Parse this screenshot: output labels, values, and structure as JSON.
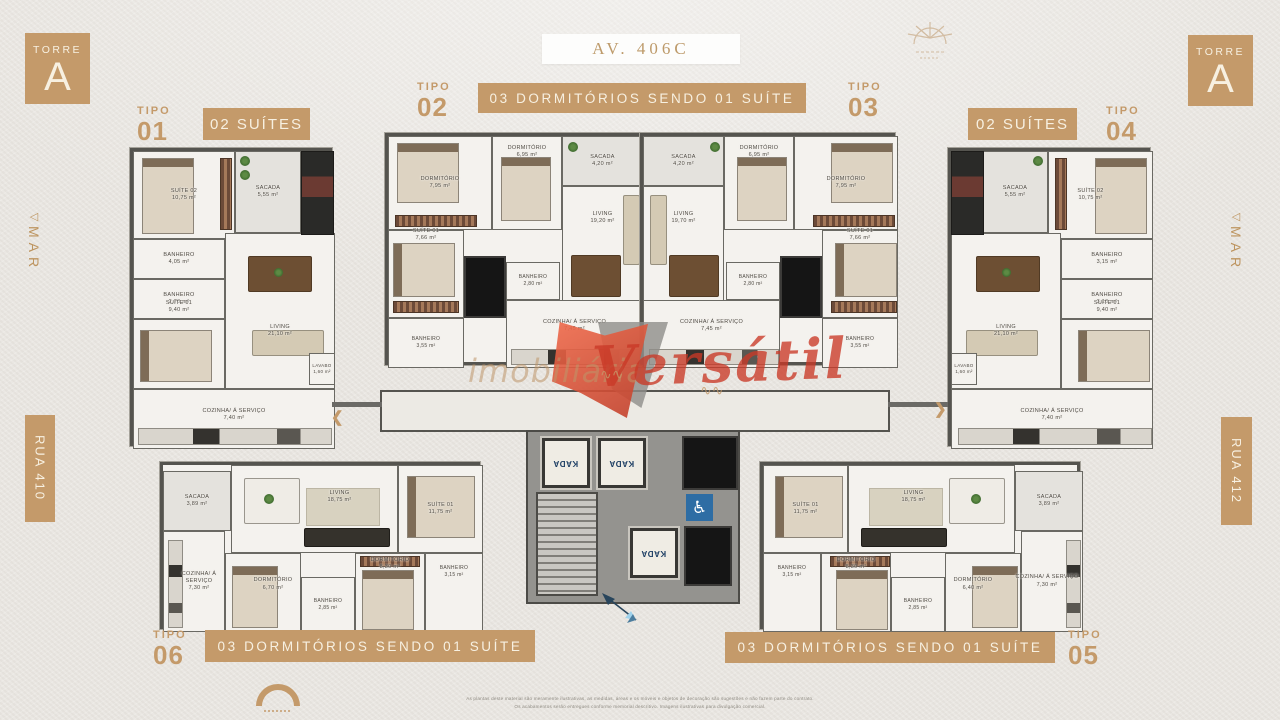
{
  "header": {
    "torre_word": "TORRE",
    "torre_letter": "A",
    "avenue": "AV. 406C"
  },
  "banners": {
    "top": "03 DORMITÓRIOS SENDO 01 SUÍTE",
    "bottom_left": "03 DORMITÓRIOS SENDO 01 SUÍTE",
    "bottom_right": "03 DORMITÓRIOS SENDO 01 SUÍTE",
    "suites_left": "02 SUÍTES",
    "suites_right": "02 SUÍTES"
  },
  "tipos": {
    "word": "TIPO",
    "t01": "01",
    "t02": "02",
    "t03": "03",
    "t04": "04",
    "t05": "05",
    "t06": "06"
  },
  "streets": {
    "mar": "MAR",
    "mar_arrow": "◁",
    "rua_left": "RUA 410",
    "rua_right": "RUA 412"
  },
  "watermark": {
    "word1": "imobiliária",
    "word2": "Versátil",
    "flourish": "∿∿"
  },
  "core": {
    "elevator_brand": "KADA",
    "accessibility_symbol": "♿"
  },
  "chevrons": {
    "left": "❮",
    "right": "❯"
  },
  "disclaimer": {
    "line1": "As plantas deste material são meramente ilustrativas, as medidas, áreas e os móveis e objetos de decoração são sugestões e não fazem parte do contrato.",
    "line2": "Os acabamentos serão entregues conforme memorial descritivo. Imagens ilustrativas para divulgação comercial."
  },
  "colors": {
    "gold": "#c49a6a",
    "banner_text": "#f7f0e1",
    "watermark_red": "#c93926",
    "accessibility_blue": "#2e6da4",
    "elevator_navy": "#1c3d63"
  },
  "units": {
    "t01": {
      "rooms": [
        {
          "name": "SUÍTE 02",
          "area": "10,75 m²"
        },
        {
          "name": "SACADA",
          "area": "5,55 m²"
        },
        {
          "name": "BANHEIRO",
          "area": "4,05 m²"
        },
        {
          "name": "BANHEIRO",
          "area": "2,70 m²"
        },
        {
          "name": "LIVING",
          "area": "21,10 m²"
        },
        {
          "name": "SUÍTE 01",
          "area": "9,40 m²"
        },
        {
          "name": "LAVABO",
          "area": "1,60 m²"
        },
        {
          "name": "COZINHA/ Á SERVIÇO",
          "area": "7,40 m²"
        }
      ]
    },
    "t02": {
      "rooms": [
        {
          "name": "DORMITÓRIO",
          "area": "7,95 m²"
        },
        {
          "name": "DORMITÓRIO",
          "area": "6,95 m²"
        },
        {
          "name": "SACADA",
          "area": "4,20 m²"
        },
        {
          "name": "LIVING",
          "area": "19,20 m²"
        },
        {
          "name": "SUÍTE 01",
          "area": "7,66 m²"
        },
        {
          "name": "BANHEIRO",
          "area": "2,80 m²"
        },
        {
          "name": "BANHEIRO",
          "area": "3,55 m²"
        },
        {
          "name": "COZINHA/ Á SERVIÇO",
          "area": "7,45 m²"
        }
      ]
    },
    "t03": {
      "rooms": [
        {
          "name": "SACADA",
          "area": "4,20 m²"
        },
        {
          "name": "DORMITÓRIO",
          "area": "6,95 m²"
        },
        {
          "name": "DORMITÓRIO",
          "area": "7,95 m²"
        },
        {
          "name": "LIVING",
          "area": "19,70 m²"
        },
        {
          "name": "BANHEIRO",
          "area": "2,80 m²"
        },
        {
          "name": "SUÍTE 01",
          "area": "7,66 m²"
        },
        {
          "name": "COZINHA/ Á SERVIÇO",
          "area": "7,45 m²"
        },
        {
          "name": "BANHEIRO",
          "area": "3,55 m²"
        }
      ]
    },
    "t04": {
      "rooms": [
        {
          "name": "SACADA",
          "area": "5,55 m²"
        },
        {
          "name": "SUÍTE 02",
          "area": "10,75 m²"
        },
        {
          "name": "BANHEIRO",
          "area": "3,15 m²"
        },
        {
          "name": "BANHEIRO",
          "area": "3,10 m²"
        },
        {
          "name": "LIVING",
          "area": "21,10 m²"
        },
        {
          "name": "SUÍTE 01",
          "area": "9,40 m²"
        },
        {
          "name": "LAVABO",
          "area": "1,60 m²"
        },
        {
          "name": "COZINHA/ Á SERVIÇO",
          "area": "7,40 m²"
        }
      ]
    },
    "t05": {
      "rooms": [
        {
          "name": "SUÍTE 01",
          "area": "11,75 m²"
        },
        {
          "name": "LIVING",
          "area": "18,75 m²"
        },
        {
          "name": "SACADA",
          "area": "3,89 m²"
        },
        {
          "name": "BANHEIRO",
          "area": "3,15 m²"
        },
        {
          "name": "DORMITÓRIO",
          "area": "8,30 m²"
        },
        {
          "name": "BANHEIRO",
          "area": "2,85 m²"
        },
        {
          "name": "DORMITÓRIO",
          "area": "6,40 m²"
        },
        {
          "name": "COZINHA/ Á SERVIÇO",
          "area": "7,30 m²"
        }
      ]
    },
    "t06": {
      "rooms": [
        {
          "name": "SACADA",
          "area": "3,89 m²"
        },
        {
          "name": "LIVING",
          "area": "18,75 m²"
        },
        {
          "name": "SUÍTE 01",
          "area": "11,75 m²"
        },
        {
          "name": "COZINHA/ Á SERVIÇO",
          "area": "7,30 m²"
        },
        {
          "name": "DORMITÓRIO",
          "area": "6,70 m²"
        },
        {
          "name": "BANHEIRO",
          "area": "2,85 m²"
        },
        {
          "name": "DORMITÓRIO",
          "area": "8,30 m²"
        },
        {
          "name": "BANHEIRO",
          "area": "3,15 m²"
        }
      ]
    }
  }
}
